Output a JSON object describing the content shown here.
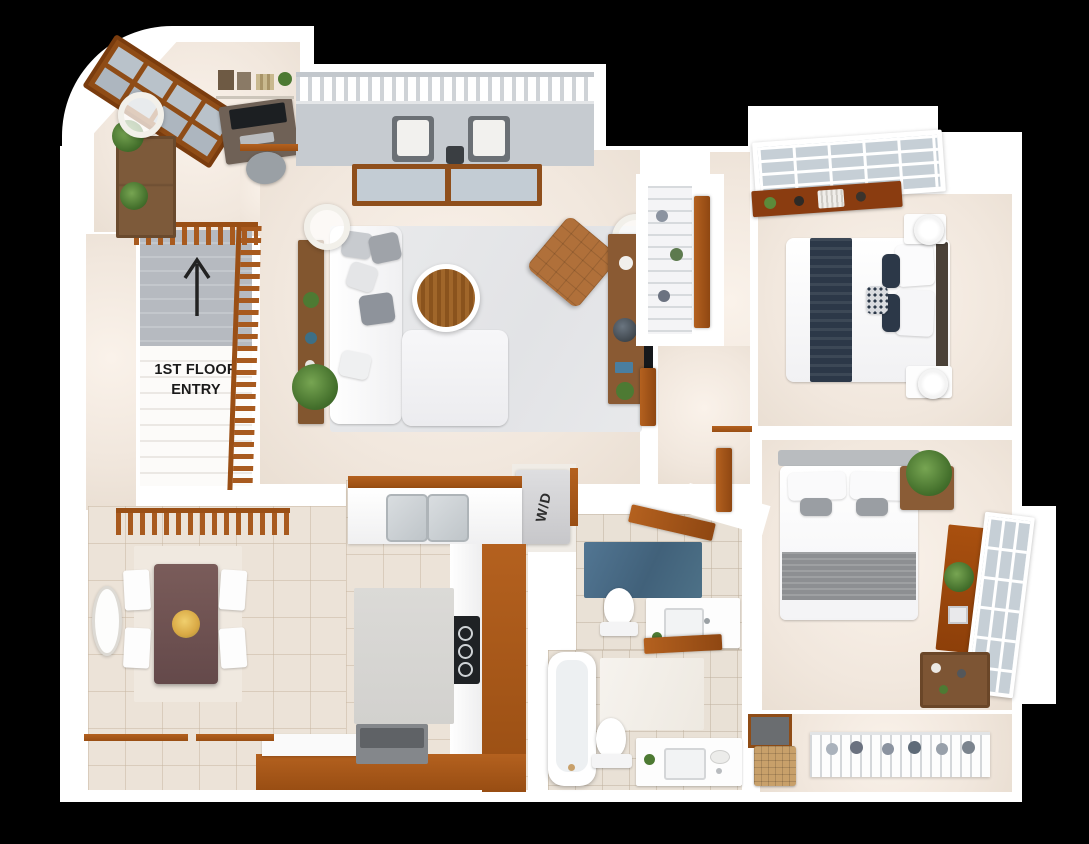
{
  "plan": {
    "stair_label_line1": "1ST FLOOR",
    "stair_label_line2": "ENTRY",
    "laundry_label": "W/D",
    "icons": {
      "stair_direction": "up-arrow"
    }
  },
  "colors": {
    "background": "#000000",
    "walls": "#ffffff",
    "wood_trim": "#a85a1e",
    "floor_cream": "#f1e7dd",
    "tile": "#ece3d8",
    "stair_gray": "#b5b9be",
    "balcony_gray": "#c6cbd0",
    "area_rug_gray": "#e7e8ea",
    "bath_rug_blue": "#4d7187",
    "bedding_navy": "#2c3848",
    "lounge_chair_tan": "#b0703a",
    "dining_table_brown": "#6f5553"
  }
}
